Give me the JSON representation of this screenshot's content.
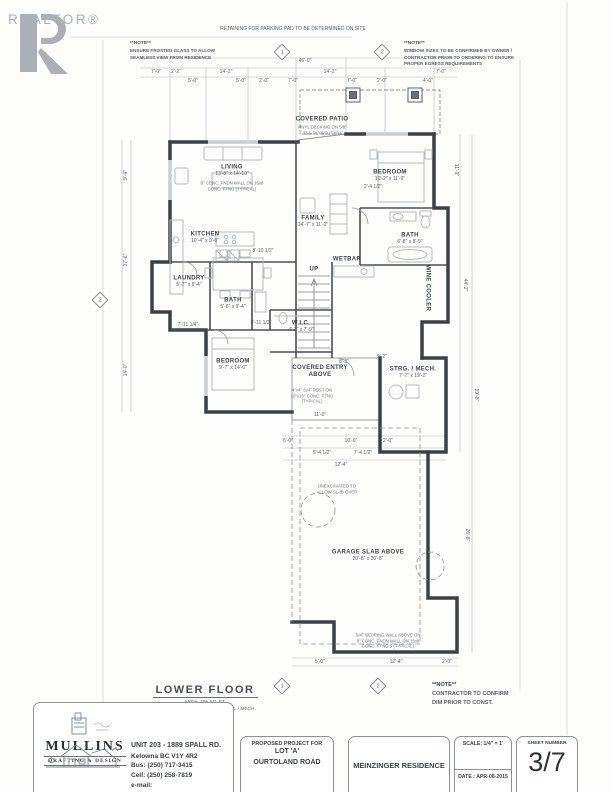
{
  "logo": {
    "wordmark": "REALTOR®"
  },
  "notes": {
    "top_banner": "RETAINING FOR PARKING PAD TO BE DETERMINED ON SITE",
    "left_title": "**NOTE**",
    "left_body": "ENSURE FROSTED GLASS TO ALLOW\nSEAMLESS VIEW FROM RESIDENCE",
    "right_title": "**NOTE**",
    "right_body": "WINDOW SIZES TO BE CONFIRMED BY OWNER /\nCONTRACTOR PRIOR TO ORDERING TO ENSURE\nPROPER EGRESS REQUIREMENTS",
    "bottom_right_title": "**NOTE**",
    "bottom_right_body": "CONTRACTOR TO CONFIRM\nDIM PRIOR TO CONST."
  },
  "plan": {
    "rooms": [
      {
        "name": "LIVING",
        "size": "13'-8\" x 14'-10\"",
        "x": 232,
        "y": 168
      },
      {
        "name": "KITCHEN",
        "size": "10'-4\" x 9'-8\"",
        "x": 205,
        "y": 235
      },
      {
        "name": "FAMILY",
        "size": "14'-7\" x 11'-2\"",
        "x": 313,
        "y": 219
      },
      {
        "name": "BEDROOM",
        "size": "10'-2\" x 11'-9\"",
        "x": 390,
        "y": 173
      },
      {
        "name": "BATH",
        "size": "6'-8\" x 8'-9\"",
        "x": 410,
        "y": 236
      },
      {
        "name": "WETBAR",
        "x": 347,
        "y": 260
      },
      {
        "name": "LAUNDRY",
        "size": "5'-7\" x 6'-4\"",
        "x": 189,
        "y": 279
      },
      {
        "name": "BATH",
        "size": "5'-6\" x 9'-4\"",
        "x": 233,
        "y": 301
      },
      {
        "name": "W.I.C.",
        "size": "4'-2\" x 7'-9\"",
        "x": 301,
        "y": 324
      },
      {
        "name": "BEDROOM",
        "size": "9'-7\" x 14'-0\"",
        "x": 233,
        "y": 362
      },
      {
        "name": "COVERED PATIO",
        "x": 322,
        "y": 120
      },
      {
        "name": "COVERED ENTRY\nABOVE",
        "x": 320,
        "y": 372
      },
      {
        "name": "STRG. / MECH.",
        "size": "7'-7\" x 19'-2\"",
        "x": 413,
        "y": 370
      },
      {
        "name": "GARAGE SLAB ABOVE",
        "size": "20'-8\" x 26'-8\"",
        "x": 368,
        "y": 553
      },
      {
        "name": "WINE COOLER",
        "x": 427,
        "y": 288,
        "rot": 90
      },
      {
        "name": "UP",
        "x": 314,
        "y": 270
      }
    ],
    "dims": [
      {
        "t": "46'-0\"",
        "x": 305,
        "y": 61
      },
      {
        "t": "7'-0\"",
        "x": 156,
        "y": 72
      },
      {
        "t": "2'-2\"",
        "x": 176,
        "y": 72
      },
      {
        "t": "14'-2\"",
        "x": 226,
        "y": 72
      },
      {
        "t": "14'-2\"",
        "x": 330,
        "y": 72
      },
      {
        "t": "7'-0\"",
        "x": 441,
        "y": 72
      },
      {
        "t": "5'-0\"",
        "x": 193,
        "y": 81
      },
      {
        "t": "5'-0\"",
        "x": 241,
        "y": 81
      },
      {
        "t": "2'-0\"",
        "x": 264,
        "y": 81
      },
      {
        "t": "7'-0\"",
        "x": 293,
        "y": 81
      },
      {
        "t": "7'-0\"",
        "x": 352,
        "y": 81
      },
      {
        "t": "2'-0\"",
        "x": 382,
        "y": 81
      },
      {
        "t": "4'-0\"",
        "x": 428,
        "y": 81
      },
      {
        "t": "8'-10 1/2\"",
        "x": 263,
        "y": 251
      },
      {
        "t": "9'-11 1/2\"",
        "x": 261,
        "y": 323
      },
      {
        "t": "7'-11 1/4\"",
        "x": 188,
        "y": 325
      },
      {
        "t": "2'-4 1/2\"",
        "x": 373,
        "y": 187
      },
      {
        "t": "11'-0\"",
        "x": 320,
        "y": 415
      },
      {
        "t": "9'-2\"",
        "x": 382,
        "y": 357
      },
      {
        "t": "8'-2\"",
        "x": 344,
        "y": 362
      },
      {
        "t": "6'-0\"",
        "x": 288,
        "y": 441
      },
      {
        "t": "10'-0\"",
        "x": 351,
        "y": 441
      },
      {
        "t": "2'-0\"",
        "x": 388,
        "y": 441
      },
      {
        "t": "5'-4 1/2\"",
        "x": 322,
        "y": 453
      },
      {
        "t": "7'-4 1/2\"",
        "x": 363,
        "y": 453
      },
      {
        "t": "12'-4\"",
        "x": 341,
        "y": 465
      },
      {
        "t": "5'-0\"",
        "x": 320,
        "y": 662
      },
      {
        "t": "12'-4\"",
        "x": 396,
        "y": 662
      },
      {
        "t": "2'-0\"",
        "x": 447,
        "y": 662
      },
      {
        "t": "9'-4\"",
        "x": 126,
        "y": 175,
        "r": -90
      },
      {
        "t": "37'-6\"",
        "x": 126,
        "y": 260,
        "r": -90
      },
      {
        "t": "14'-0\"",
        "x": 126,
        "y": 370,
        "r": -90
      },
      {
        "t": "11'-9\"",
        "x": 456,
        "y": 170,
        "r": 90
      },
      {
        "t": "44'-2\"",
        "x": 465,
        "y": 285,
        "r": 90
      },
      {
        "t": "29'-8\"",
        "x": 476,
        "y": 395,
        "r": 90
      },
      {
        "t": "26'-8\"",
        "x": 467,
        "y": 535,
        "r": 90
      }
    ],
    "notes": [
      {
        "t": "8\" CONC. FNDN WALL ON 16x8\nCONC. FTNG (TYPICAL)",
        "x": 232,
        "y": 186
      },
      {
        "t": "VINYL DECKING ON 5/8\"\nT&G PLYWD (TYP.)",
        "x": 322,
        "y": 130
      },
      {
        "t": "4\"x4\" SAF POST ON\n10\"x10\" CONC. FTNG\n(TYPICAL)",
        "x": 312,
        "y": 396
      },
      {
        "t": "UNEXCAVATED TO\nALLOW SLAB OVER",
        "x": 337,
        "y": 489
      },
      {
        "t": "SAF BEARING WALL ABOVE ON\n8\" CONC. FNDN WALL ON 16x8\nCONC. FTNG'S (TYPICAL)",
        "x": 388,
        "y": 641
      }
    ],
    "markers": [
      {
        "n": "1",
        "x": 282,
        "y": 52
      },
      {
        "n": "2",
        "x": 382,
        "y": 52
      },
      {
        "n": "2",
        "x": 100,
        "y": 300
      },
      {
        "n": "1",
        "x": 282,
        "y": 686
      },
      {
        "n": "2",
        "x": 378,
        "y": 686
      }
    ]
  },
  "lower_floor": {
    "title": "LOWER FLOOR",
    "area_label": "AREA:",
    "area_value": "705 SQ. FT.",
    "excluding": "EXCLUDING STAIRS / ELEV. / STRG. / MECH.",
    "suite_label": "SUITE AREA:",
    "suite_value": "728 SQ. FT."
  },
  "titleblock": {
    "company": {
      "name": "MULLINS",
      "tagline": "DRAFTING & DESIGN"
    },
    "contact": {
      "line1": "UNIT 203 - 1889 SPALL RD.",
      "line2": "Kelowna BC V1Y 4R2",
      "line3": "Bus: (250) 717-3415",
      "line4": "Cell: (250) 258-7819",
      "line5": "e-mail: mullinsdrafting@shaw.ca"
    },
    "project": {
      "heading": "PROPOSED PROJECT FOR",
      "line1": "LOT 'A'",
      "line2": "OURTOLAND ROAD"
    },
    "residence": "MEINZINGER RESIDENCE",
    "scale_label": "SCALE: 1/4\" = 1'",
    "date_label": "DATE : APR-08-2015",
    "sheet_heading": "SHEET NUMBER",
    "sheet_number": "3/7"
  },
  "colors": {
    "line": "#4a4e52",
    "wall": "#3d4044",
    "furniture": "#b7babd",
    "logo_grey": "#aab0b6",
    "stamp_blue": "#7c90ad"
  }
}
